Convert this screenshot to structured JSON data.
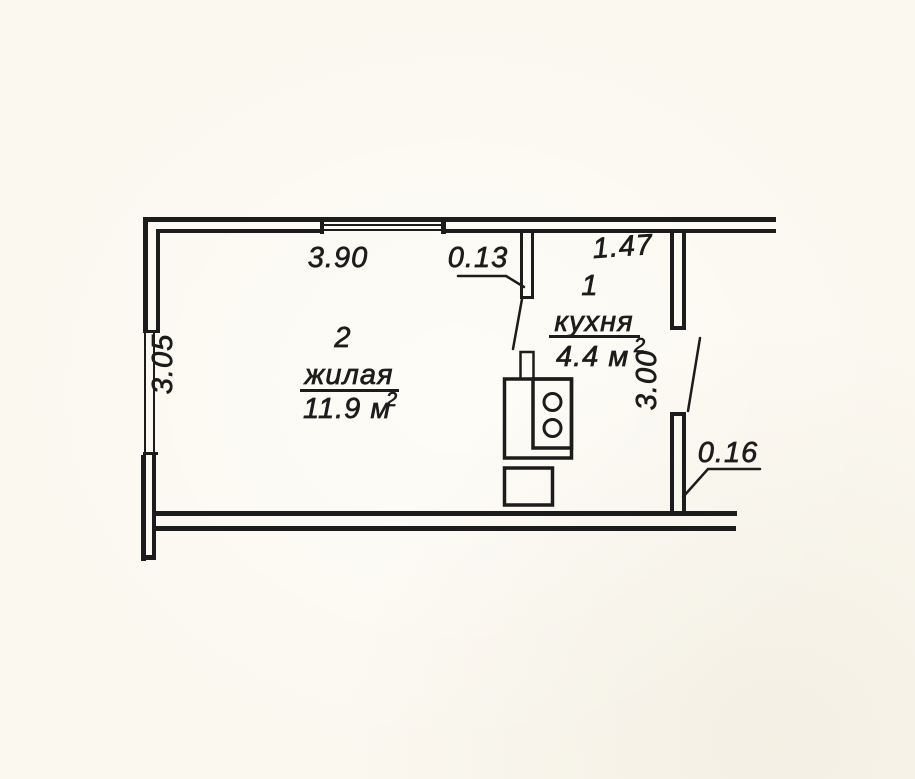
{
  "rooms": [
    {
      "number": "1",
      "name": "кухня",
      "area_label": "4.4 м",
      "area_sup": "2"
    },
    {
      "number": "2",
      "name": "жилая",
      "area_label": "11.9 м",
      "area_sup": "2"
    }
  ],
  "dimensions": {
    "top_window_width": "3.90",
    "partition_thickness": "0.13",
    "kitchen_top_width": "1.47",
    "left_wall_height": "3.05",
    "kitchen_right_height": "3.00",
    "right_wall_thickness": "0.16"
  },
  "icons": {
    "stove": "stove-icon",
    "sink": "sink-icon",
    "window_top": "window-icon",
    "window_left": "window-icon",
    "door_kitchen": "door-swing-icon",
    "door_hall": "door-swing-icon"
  },
  "colors": {
    "ink": "#1c1c1c",
    "paper": "#fbf8f0"
  }
}
